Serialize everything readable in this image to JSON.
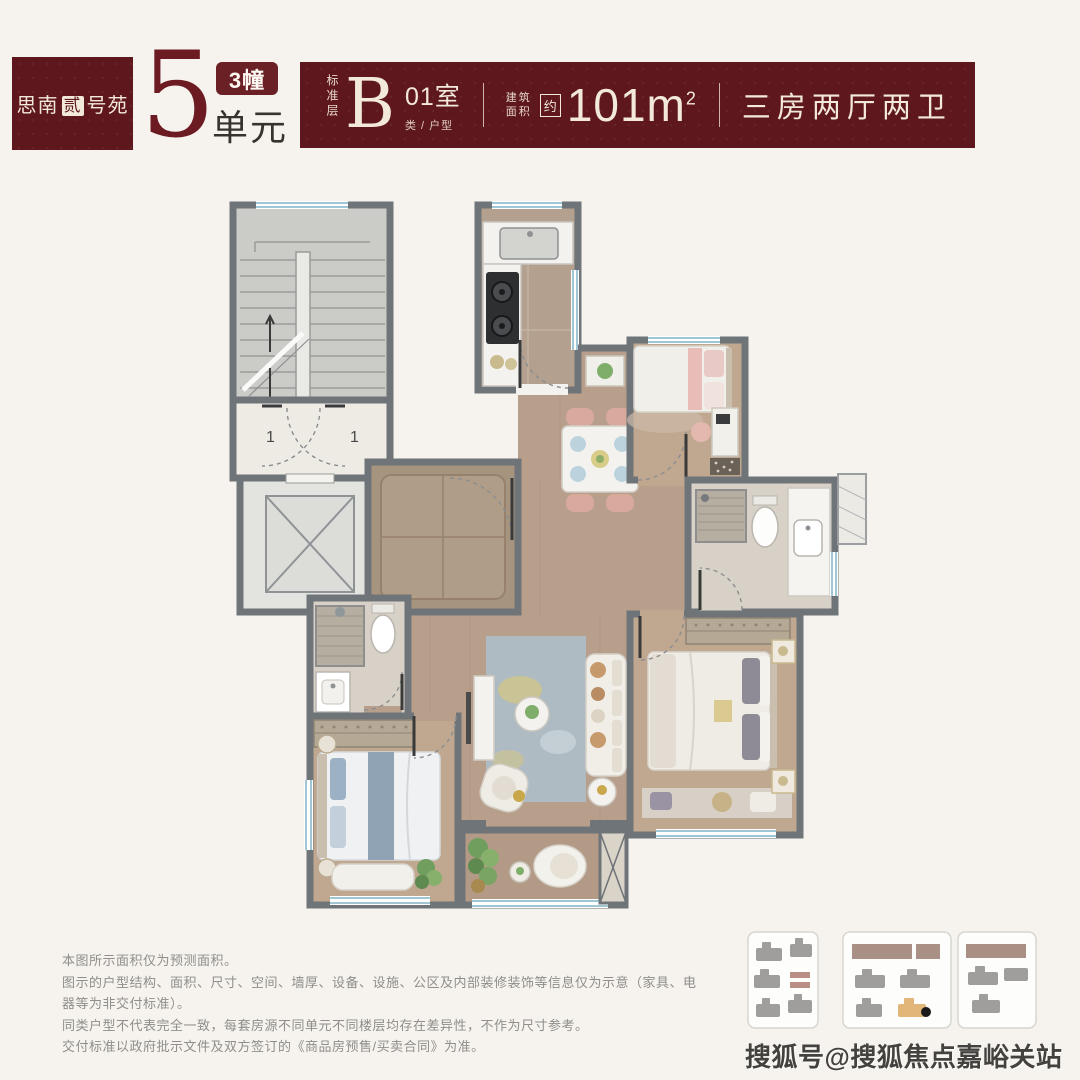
{
  "header": {
    "project": {
      "prefix": "思南",
      "boxed_char": "贰",
      "suffix": "号苑"
    },
    "unit_number": "5",
    "building_badge": "3幢",
    "unit_label": "单元",
    "banner": {
      "floor_label": "标准层",
      "type_letter": "B",
      "room_no": "01室",
      "type_sub": "类 / 户型",
      "area_label_line1": "建筑",
      "area_label_line2": "面积",
      "approx": "约",
      "area_value": "101m",
      "area_sup": "2",
      "layout": "三房两厅两卫"
    },
    "colors": {
      "maroon": "#5e181d",
      "cream": "#f3e9da"
    }
  },
  "floor_plan": {
    "door_labels": [
      "1",
      "1"
    ],
    "rooms": [
      "staircase",
      "elevator",
      "entry-hall",
      "kitchen",
      "dining",
      "bedroom-1",
      "bathroom-1",
      "master-bedroom",
      "living-room",
      "balcony",
      "bathroom-2",
      "bedroom-2"
    ]
  },
  "footer": {
    "disclaimer": [
      "本图所示面积仅为预测面积。",
      "图示的户型结构、面积、尺寸、空间、墙厚、设备、设施、公区及内部装修装饰等信息仅为示意（家具、电器等为非交付标准）。",
      "同类户型不代表完全一致，每套房源不同单元不同楼层均存在差异性，不作为尺寸参考。",
      "交付标准以政府批示文件及双方签订的《商品房预售/买卖合同》为准。"
    ],
    "watermark": "搜狐号@搜狐焦点嘉峪关站"
  }
}
